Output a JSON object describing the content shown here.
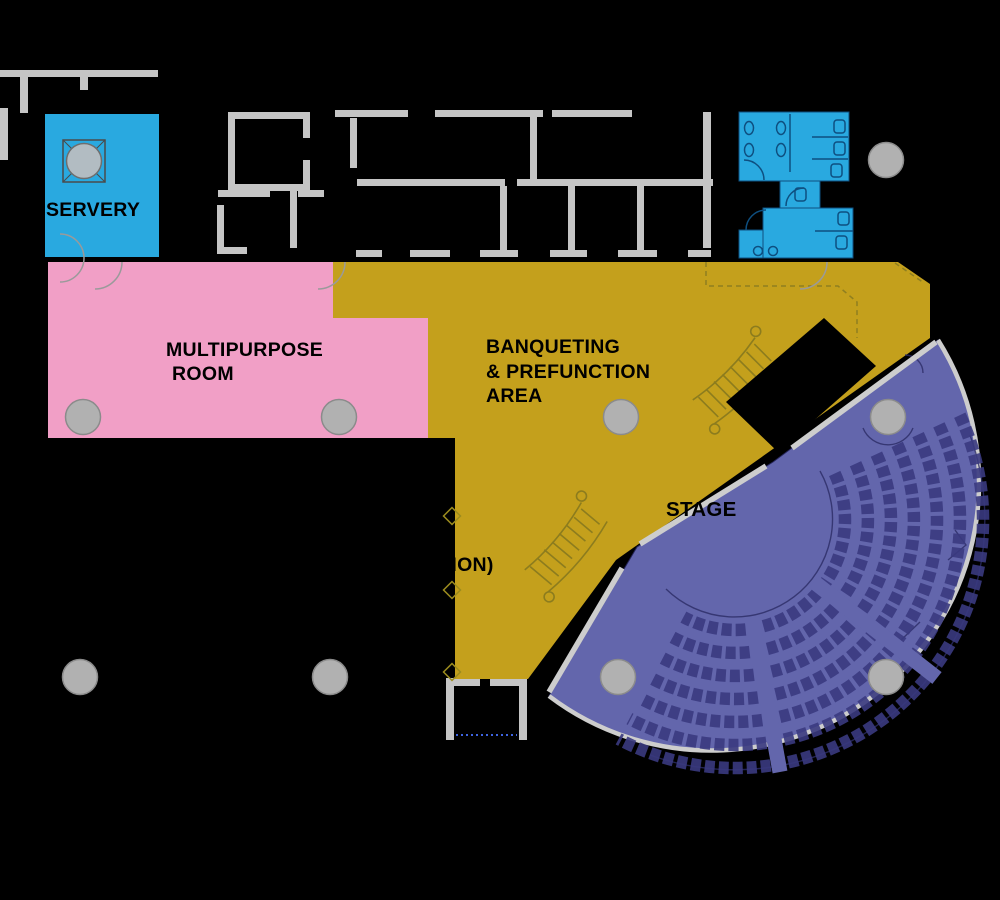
{
  "canvas": {
    "width": 1000,
    "height": 900,
    "background": "#000000"
  },
  "rooms": [
    {
      "id": "servery",
      "label": "SERVERY",
      "color": "#29A9E0"
    },
    {
      "id": "multipurpose-room",
      "label": "MULTIPURPOSE ROOM",
      "lines": [
        "MULTIPURPOSE",
        "ROOM"
      ],
      "color": "#F19FC6"
    },
    {
      "id": "banqueting-prefunction-area",
      "label": "BANQUETING & PREFUNCTION AREA",
      "lines": [
        "BANQUETING",
        "& PREFUNCTION",
        "AREA"
      ],
      "color": "#C4A01C"
    },
    {
      "id": "open-terrace-prefunction",
      "label": "OPEN TERRACE (PREFUNCTION)",
      "lines": [
        "OPEN",
        "TERRACE",
        "(PREFUNCTION)"
      ],
      "color": "#000000"
    },
    {
      "id": "stage-auditorium",
      "label": "STAGE",
      "color": "#6366AC"
    },
    {
      "id": "washrooms",
      "label": "",
      "color": "#29A9E0"
    }
  ],
  "structure": {
    "wall_color": "#C5C5C5",
    "column_color": "#B1B1B1",
    "column_count": 10,
    "seat_rows": 7,
    "seat_color": "#3A3A80",
    "rim_color": "#CDCDCD",
    "detail_line_color": "#2C2C66",
    "fixture_line_color": "#0E4F80",
    "stair_color": "#8C7C1E",
    "door_arc_color": "#9A9A9A",
    "dotted_threshold_color": "#3E64E0"
  }
}
